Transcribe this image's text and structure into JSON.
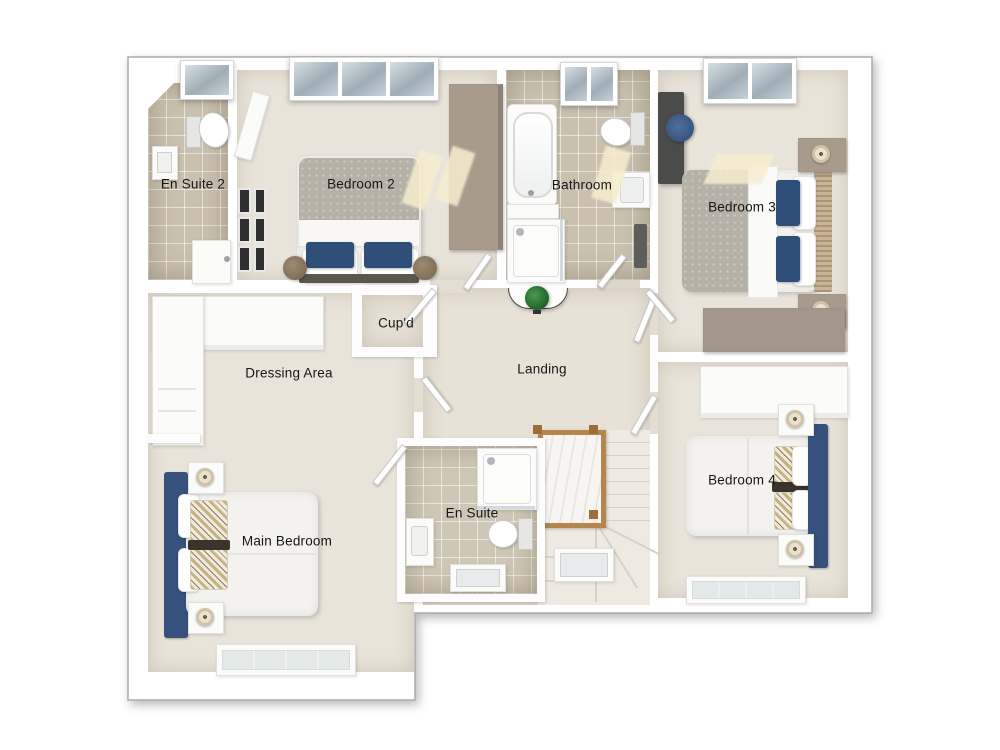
{
  "plan": {
    "type": "floorplan-3d-top-view",
    "rooms": {
      "en_suite_2": {
        "label": "En Suite 2"
      },
      "bedroom_2": {
        "label": "Bedroom 2"
      },
      "bathroom": {
        "label": "Bathroom"
      },
      "bedroom_3": {
        "label": "Bedroom 3"
      },
      "cupboard": {
        "label": "Cup'd"
      },
      "dressing_area": {
        "label": "Dressing Area"
      },
      "landing": {
        "label": "Landing"
      },
      "en_suite": {
        "label": "En Suite"
      },
      "main_bedroom": {
        "label": "Main Bedroom"
      },
      "bedroom_4": {
        "label": "Bedroom 4"
      }
    },
    "colors": {
      "background": "#ffffff",
      "wall": "#fdfdfd",
      "wall_outline": "#ababab",
      "carpet": "#e9e4da",
      "tile": "#c9c0ae",
      "accent_navy": "#35517c",
      "pillow_navy": "#2f4f78",
      "taupe_furniture": "#a89b8c",
      "grey_throw": "#b6b1a6",
      "wood_stairs": "#b5854e",
      "plant_green": "#2f7d33",
      "sunlight": "#f7eecf",
      "label_text": "#161616"
    }
  }
}
